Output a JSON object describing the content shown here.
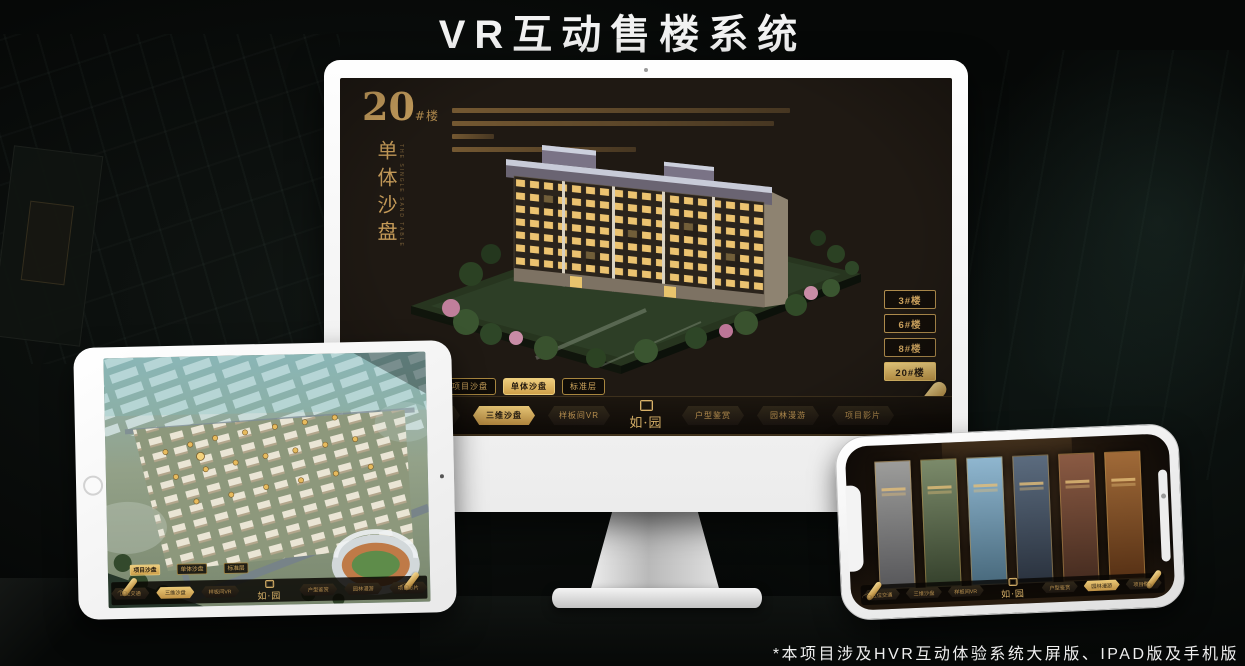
{
  "page": {
    "title": "VR互动售楼系统",
    "footnote": "*本项目涉及HVR互动体验系统大屏版、IPAD版及手机版"
  },
  "brand": {
    "logo": "如·园"
  },
  "nav": {
    "items": [
      {
        "label": "区位交通"
      },
      {
        "label": "三维沙盘"
      },
      {
        "label": "样板间VR"
      },
      {
        "label": "户型鉴赏"
      },
      {
        "label": "园林漫游"
      },
      {
        "label": "项目影片"
      }
    ]
  },
  "monitor": {
    "heading": {
      "number": "20",
      "suffix": "#楼",
      "subtitle_vertical": "单体沙盘",
      "subtitle_en": "THE SINGLE SAND TABLE"
    },
    "floor_buttons": [
      {
        "label": "3#楼",
        "selected": false
      },
      {
        "label": "6#楼",
        "selected": false
      },
      {
        "label": "8#楼",
        "selected": false
      },
      {
        "label": "20#楼",
        "selected": true
      }
    ],
    "sub_tabs": [
      {
        "label": "项目沙盘",
        "selected": false
      },
      {
        "label": "单体沙盘",
        "selected": true
      },
      {
        "label": "标准层",
        "selected": false
      }
    ],
    "active_nav_item": "三维沙盘"
  },
  "tablet": {
    "sub_tabs": [
      {
        "label": "项目沙盘",
        "selected": true
      },
      {
        "label": "单体沙盘",
        "selected": false
      },
      {
        "label": "标准层",
        "selected": false
      }
    ],
    "active_nav_item": "三维沙盘"
  },
  "phone": {
    "active_nav_item": "园林漫游",
    "gallery_panel_count": 6
  },
  "colors": {
    "gold": "#c9a05c",
    "gold_bright": "#ecca78",
    "screen_bg": "#1f1913",
    "nav_bg": "#16110c",
    "title_text": "#f2f2f2"
  }
}
